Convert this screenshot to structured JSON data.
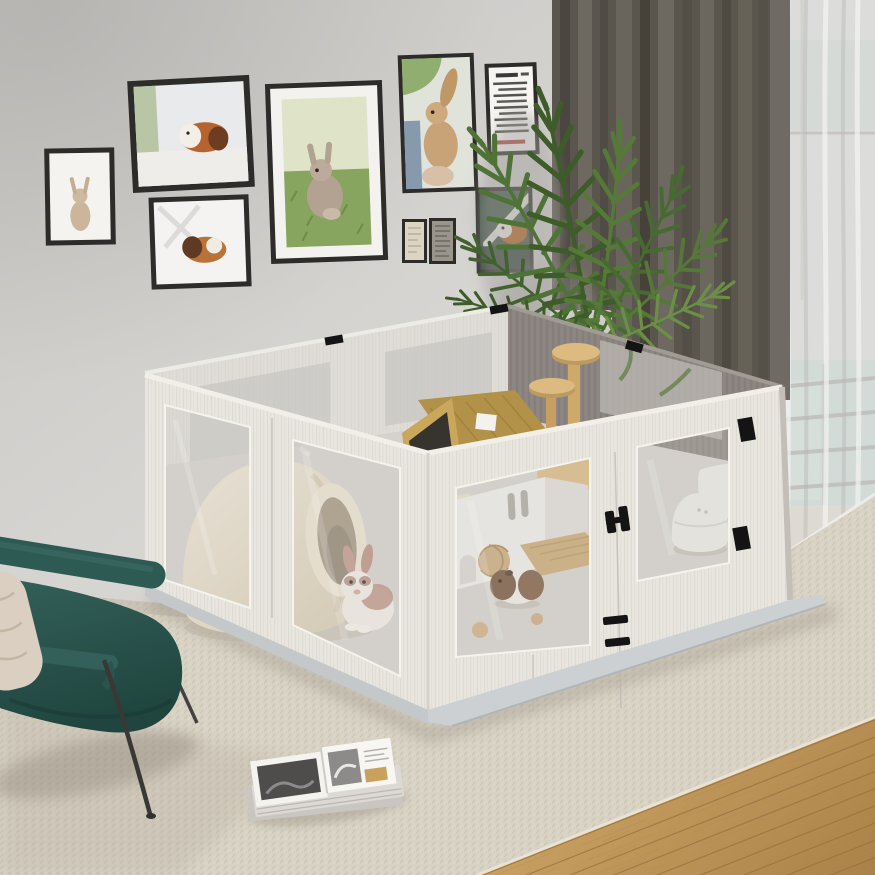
{
  "scene": {
    "description": "Bright living room photo: large white-wood DIY small-pet playpen with clear acrylic windows holding rabbit and guinea pig hideouts, gallery wall of pet art prints, areca palm, dark green leather armchair, woven beige rug over oak floor, olive blackout curtain and sheer curtain by a balcony window",
    "gallery_wall": {
      "frames": [
        {
          "id": "frame-1",
          "subject": "standing tan rabbit art print",
          "orientation": "portrait"
        },
        {
          "id": "frame-2",
          "subject": "guinea pig on windowsill photo",
          "orientation": "landscape"
        },
        {
          "id": "frame-3",
          "subject": "resting guinea pig photo",
          "orientation": "landscape"
        },
        {
          "id": "frame-4",
          "subject": "baby rabbit sitting on grass photo",
          "orientation": "portrait"
        },
        {
          "id": "frame-5",
          "subject": "rabbit with tall ear held up photo",
          "orientation": "portrait"
        },
        {
          "id": "frame-6",
          "subject": "small-pet info text poster",
          "orientation": "portrait"
        },
        {
          "id": "frame-7",
          "subject": "pair of tiny sketch prints",
          "orientation": "portrait"
        },
        {
          "id": "frame-8",
          "subject": "guinea pig on dark green chair photo",
          "orientation": "portrait"
        }
      ]
    },
    "enclosure": {
      "description": "Square modular pet playpen, whitewashed wood grain panels, clear acrylic windows, black clip hardware, on a light gray base plate",
      "contents": [
        "cream igloo hideout with round tunnel entrance",
        "white rabbit with brown markings",
        "wooden A-frame chalet with label",
        "two-tier round platform climbing tree",
        "small wooden ladder toy",
        "white hideout house with slot windows",
        "tan wooden mat",
        "woven wicker balls",
        "brown and white guinea pig",
        "white dome pet bed",
        "white pet cushion"
      ],
      "hardware": [
        "black corner clips",
        "black hinge",
        "black vent slots"
      ]
    },
    "plant": {
      "type": "areca palm in planter box"
    },
    "curtains": {
      "left": "olive-gray blackout drape",
      "right": "white sheer over balcony window with railing"
    },
    "armchair": {
      "style": "dark teal leather lounge chair, black metal legs, beige cushion"
    },
    "rug": {
      "style": "beige woven flatweave rug"
    },
    "floor": {
      "style": "oak wood planks, bottom right corner"
    },
    "magazines": {
      "style": "stack of open magazines with black and white photos"
    }
  },
  "colors": {
    "wall": "#d7d5d2",
    "wall_dark": "#c7c5c2",
    "curtain_dark": "#5a554d",
    "curtain_sheer": "#e6e5e3",
    "window_glass": "#a9c8c0",
    "plant_dark": "#3d5c2a",
    "plant_mid": "#4f7336",
    "plant_light": "#6b8f47",
    "pen_wood": "#e9e6e0",
    "pen_back_wall": "#8b8580",
    "pen_inner_wall": "#e0ddd8",
    "pen_floor": "#d5d2cd",
    "acrylic": "#cfccc6",
    "hardware": "#141414",
    "base_plate": "#cdd0d2",
    "rug_base": "#d8d2c5",
    "rug_weave": "#c4bcab",
    "wood_light": "#cda566",
    "wood_dark": "#aa8148",
    "chair_light": "#336059",
    "chair_dark": "#20453f",
    "cushion": "#dacfc0",
    "igloo_light": "#f0e9da",
    "igloo_dark": "#d8cbb4",
    "rabbit_fur": "#f2ede6",
    "rabbit_patch": "#b98c80",
    "aframe_roof": "#b29148",
    "aframe_face": "#c9a85c",
    "cat_tree_wood": "#ddbb80",
    "white_house": "#efedea",
    "mat_tan": "#c9a76f",
    "wicker": "#c9a87a",
    "guinea_brown": "#6f4f38",
    "dome_bed": "#ecebe7",
    "magazine_page": "#f4f3f0",
    "photo_dark": "#4e4d4b",
    "frame_black": "#2e2c2a",
    "frame_mat": "#f4f2ee",
    "poster_accent": "#b5453c"
  }
}
